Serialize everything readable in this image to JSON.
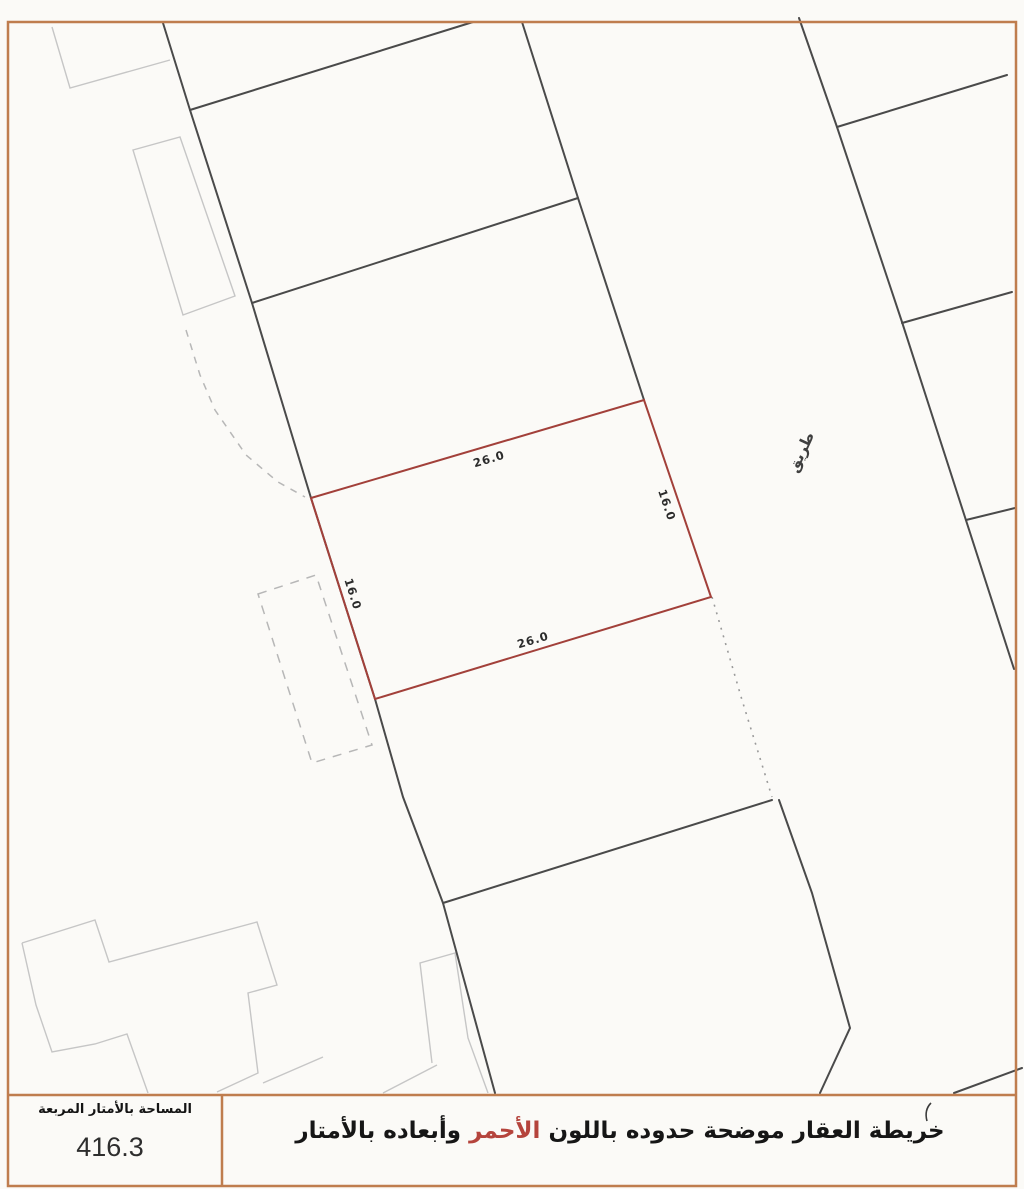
{
  "map": {
    "road_label": "طريق",
    "parcel_dims": {
      "top": "26.0",
      "bottom": "26.0",
      "left": "16.0",
      "right": "16.0"
    }
  },
  "footer": {
    "area_label": "المساحة بالأمتار المربعة",
    "area_value": "416.3",
    "caption_before": "خريطة العقار موضحة حدوده باللون",
    "caption_red": "الأحمر",
    "caption_after": "وأبعاده بالأمتار"
  },
  "colors": {
    "page_border": "#bf7d4e",
    "parcel_outline": "#a2403a",
    "boundary_line": "#4a4a4a",
    "building_faint": "#c6c6c6",
    "caption_red_text": "#b5443c"
  }
}
